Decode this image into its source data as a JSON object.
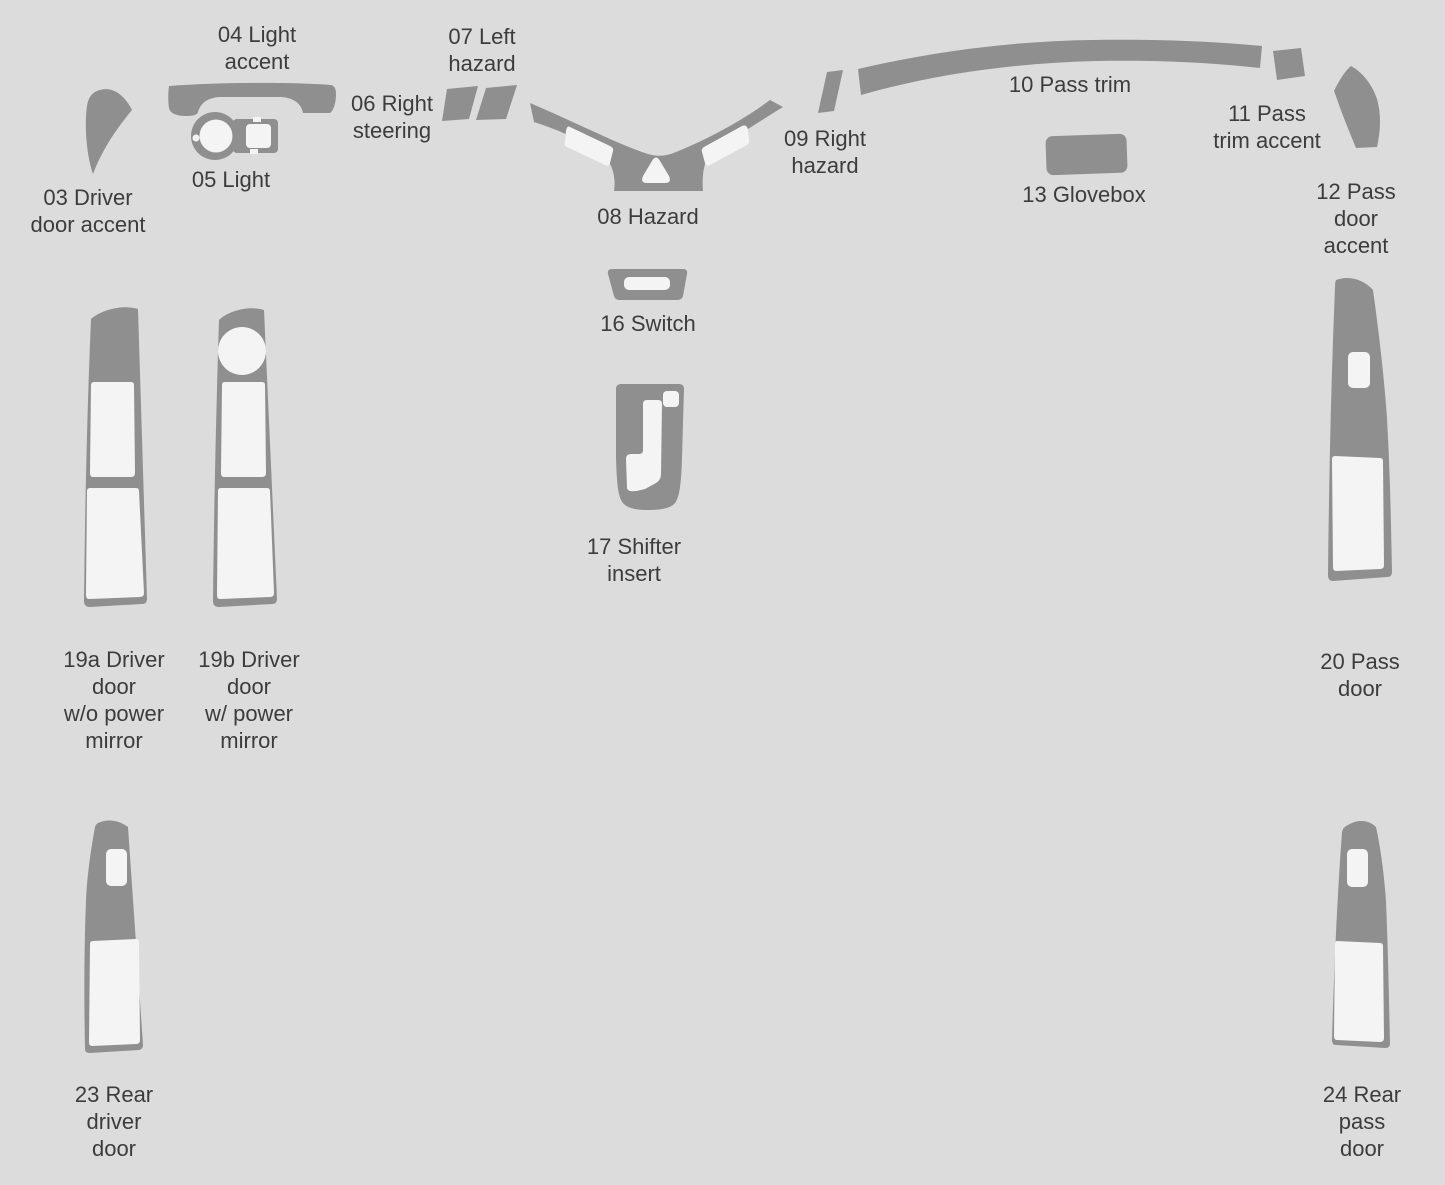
{
  "canvas": {
    "background": "#dcdcdc",
    "part_color": "#8f8f8f",
    "cutout_color": "#f4f4f4",
    "label_color": "#3c3c3c"
  },
  "parts": [
    {
      "id": "03",
      "label": "03 Driver\ndoor accent"
    },
    {
      "id": "04",
      "label": "04 Light\naccent"
    },
    {
      "id": "05",
      "label": "05 Light"
    },
    {
      "id": "06",
      "label": "06 Right\nsteering"
    },
    {
      "id": "07",
      "label": "07 Left\nhazard"
    },
    {
      "id": "08",
      "label": "08 Hazard"
    },
    {
      "id": "09",
      "label": "09 Right\nhazard"
    },
    {
      "id": "10",
      "label": "10 Pass trim"
    },
    {
      "id": "11",
      "label": "11 Pass\ntrim accent"
    },
    {
      "id": "12",
      "label": "12 Pass\ndoor accent"
    },
    {
      "id": "13",
      "label": "13 Glovebox"
    },
    {
      "id": "16",
      "label": "16 Switch"
    },
    {
      "id": "17",
      "label": "17 Shifter\ninsert"
    },
    {
      "id": "19a",
      "label": "19a Driver\ndoor\nw/o power\nmirror"
    },
    {
      "id": "19b",
      "label": "19b Driver\ndoor\nw/ power\nmirror"
    },
    {
      "id": "20",
      "label": "20 Pass\ndoor"
    },
    {
      "id": "23",
      "label": "23 Rear\ndriver\ndoor"
    },
    {
      "id": "24",
      "label": "24 Rear\npass\ndoor"
    }
  ]
}
